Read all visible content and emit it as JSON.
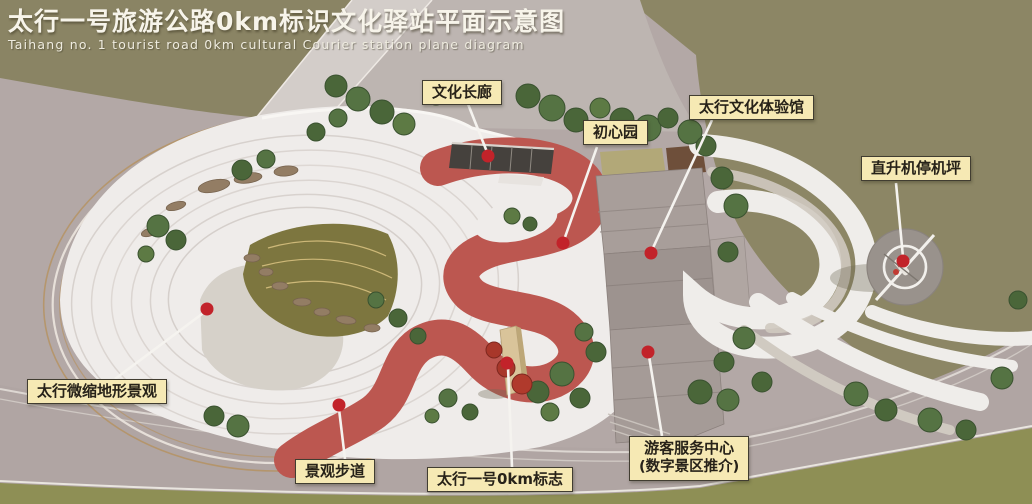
{
  "title": {
    "zh": "太行一号旅游公路0km标识文化驿站平面示意图",
    "en": "Taihang no. 1 tourist road 0km cultural Courier station plane diagram"
  },
  "labels": [
    {
      "id": "cultural-corridor",
      "text": "文化长廊"
    },
    {
      "id": "chuxin-garden",
      "text": "初心园"
    },
    {
      "id": "culture-hall",
      "text": "太行文化体验馆"
    },
    {
      "id": "helipad",
      "text": "直升机停机坪"
    },
    {
      "id": "miniature-terrain",
      "text": "太行微缩地形景观"
    },
    {
      "id": "landscape-trail",
      "text": "景观步道"
    },
    {
      "id": "zero-km-sign",
      "text": "太行一号0km标志"
    },
    {
      "id": "visitor-center",
      "text": "游客服务中心",
      "subtext": "(数字景区推介)"
    }
  ],
  "colors": {
    "marker_red": "#c2232a",
    "label_bg": "#f6e9b4",
    "label_border": "#413d31",
    "walkway_red": "#bc5750",
    "grass_olive": "#8a8464",
    "plaza_white": "#efecea",
    "road_mauve": "#b3a8a6",
    "title_text": "#f7f4ea"
  }
}
